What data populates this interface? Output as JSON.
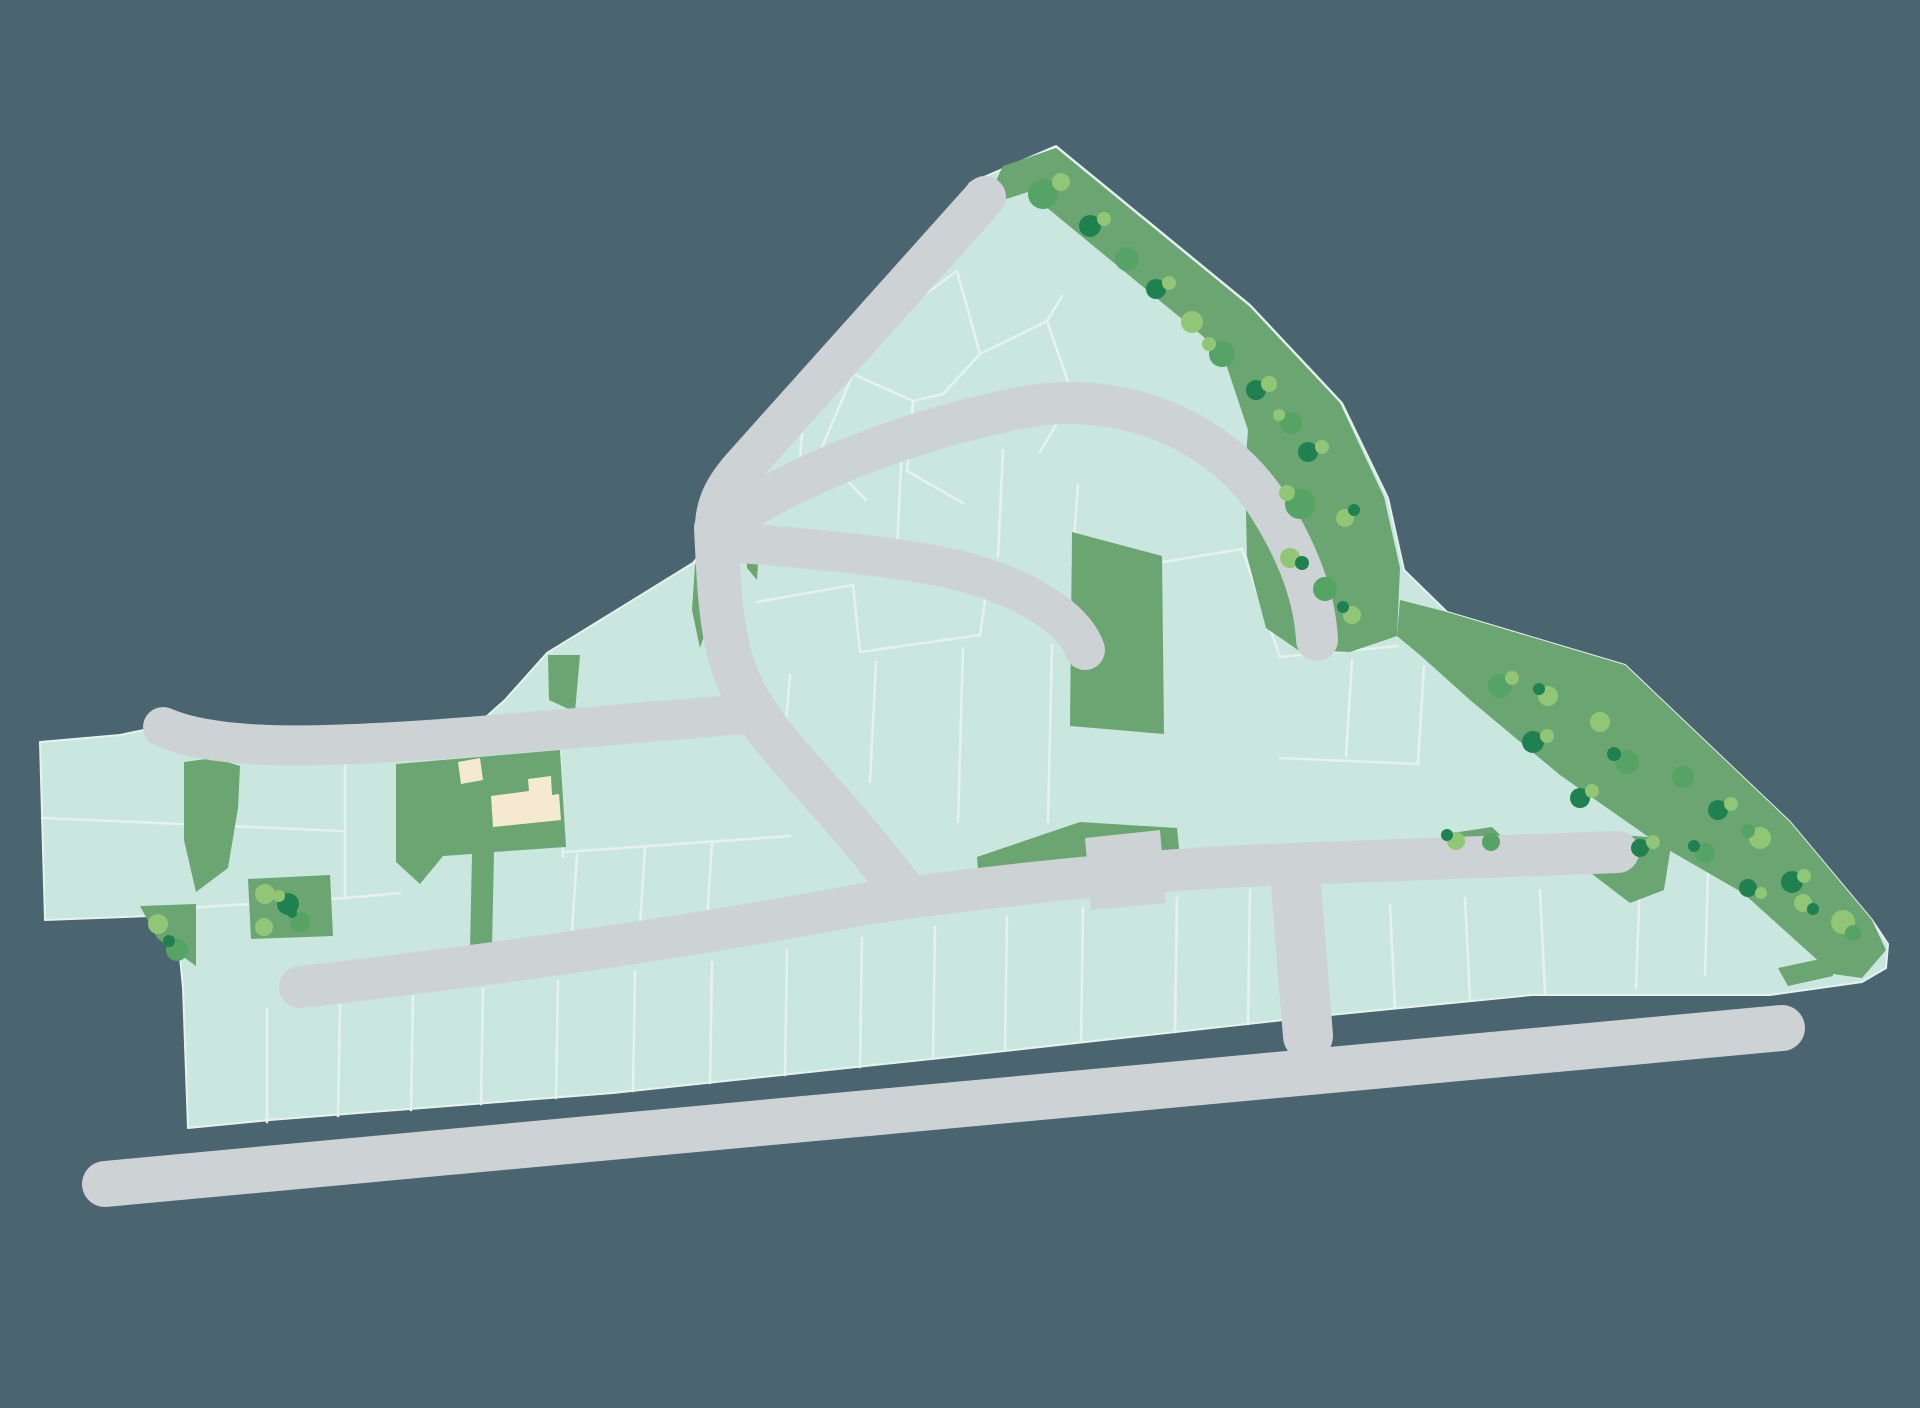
{
  "meta": {
    "title": "Residential development site plan",
    "canvas": {
      "width": 1920,
      "height": 1408
    }
  },
  "palette": {
    "background": "#4b6570",
    "parcel": "#c9e7df",
    "parcel_line": "#e6f2ee",
    "green": "#6ba572",
    "road": "#cdd2d4",
    "building": "#f6e9d2",
    "tree_light": "#90c675",
    "tree_mid": "#55a365",
    "tree_dark": "#1f8050"
  },
  "icons": {
    "tree_glyph": "circle-blob-cluster",
    "road_end_glyph": "rounded-cap",
    "building_glyph": "cream-footprint"
  },
  "site_outline": "970,183 1056,146 1250,305 1342,403 1388,498 1404,570 1447,612 1625,665 1790,822 1872,920 1888,944 1886,968 1862,982 1770,995 1532,995 1320,1016 950,1057 613,1093 270,1120 188,1128 183,988 176,915 45,920 40,742 120,735 163,726 300,747 460,740 505,700 547,653 693,563 712,540 716,528 860,365",
  "green_areas": [
    {
      "name": "northeast-tree-belt",
      "points": "1003,166 1056,148 1250,307 1340,403 1384,497 1400,568 1397,636 1350,652 1298,650 1266,628 1247,556 1245,470 1248,430 1222,352 1028,192 984,206"
    },
    {
      "name": "southeast-tree-belt",
      "points": "1400,600 1447,612 1625,665 1790,822 1872,920 1886,950 1862,978 1833,974 1743,893 1660,845 1560,775 1470,700 1420,655 1397,636"
    },
    {
      "name": "central-green-strip",
      "points": "1072,532 1162,556 1164,734 1070,726"
    },
    {
      "name": "building-parcel-green",
      "points": "396,764 560,750 566,847 494,852 492,948 470,950 472,854 443,856 420,884 396,862"
    },
    {
      "name": "west-green-wedge",
      "points": "184,762 214,758 240,766 238,808 228,868 196,892 184,840"
    },
    {
      "name": "southwest-corner-green",
      "points": "140,906 196,904 196,966 157,938"
    },
    {
      "name": "west-tree-pocket",
      "points": "248,879 330,875 333,936 251,939"
    },
    {
      "name": "roadside-green-mound",
      "points": "1437,857 1452,833 1492,827 1517,851 1517,858"
    },
    {
      "name": "east-road-head-green",
      "points": "1585,832 1672,839 1664,890 1630,903 1592,874"
    },
    {
      "name": "bypass-corner-green",
      "points": "1778,968 1830,957 1833,976 1788,986"
    },
    {
      "name": "driveway-green",
      "points": "977,857 1080,822 1177,828 1180,858 1080,874 979,884"
    },
    {
      "name": "green-sliver-a",
      "points": "548,655 580,655 575,712 549,700"
    },
    {
      "name": "green-sliver-b",
      "points": "695,565 713,545 716,600 700,648 692,610"
    },
    {
      "name": "green-sliver-c",
      "points": "745,538 760,532 757,580 747,568"
    }
  ],
  "roads": [
    {
      "name": "bypass-road",
      "d": "M105,1184 L1782,1028",
      "width": 46
    },
    {
      "name": "lower-spine-road",
      "d": "M300,987 C520,962 700,935 870,903 C1050,878 1180,868 1290,864 L1618,852",
      "width": 42
    },
    {
      "name": "west-access-road",
      "d": "M163,727 C220,752 330,748 480,736 C590,727 680,720 756,713",
      "width": 40
    },
    {
      "name": "central-link-road",
      "d": "M716,528 C720,610 722,652 748,700 C778,752 830,795 905,893",
      "width": 44
    },
    {
      "name": "north-diagonal-road",
      "d": "M985,197 L745,465 C725,487 716,505 716,528",
      "width": 42
    },
    {
      "name": "north-arc-road",
      "d": "M716,528 C790,478 900,432 1020,408 C1120,388 1220,430 1268,505 C1300,555 1315,600 1317,640",
      "width": 42
    },
    {
      "name": "central-spur-road",
      "d": "M740,543 C830,550 910,558 965,572 C1030,590 1075,620 1085,650",
      "width": 40
    },
    {
      "name": "connector-road",
      "d": "M1295,872 L1308,1036",
      "width": 50
    }
  ],
  "driveway": {
    "name": "driveway-pad",
    "points": "1085,838 1160,830 1166,903 1091,910"
  },
  "buildings": [
    {
      "name": "outbuilding",
      "points": "458,762 480,758 483,780 461,784"
    },
    {
      "name": "main-building",
      "points": "491,796 529,791 528,779 551,776 552,795 559,794 561,820 493,827"
    }
  ],
  "plot_lines": [
    [
      42,
      818,
      343,
      831
    ],
    [
      345,
      740,
      345,
      898
    ],
    [
      186,
      908,
      345,
      898
    ],
    [
      345,
      898,
      400,
      893
    ],
    [
      560,
      752,
      563,
      857
    ],
    [
      566,
      852,
      790,
      836
    ],
    [
      577,
      855,
      572,
      930
    ],
    [
      645,
      848,
      640,
      925
    ],
    [
      712,
      842,
      707,
      920
    ],
    [
      803,
      418,
      797,
      502
    ],
    [
      903,
      428,
      897,
      547
    ],
    [
      1003,
      450,
      998,
      557
    ],
    [
      1078,
      485,
      1072,
      565
    ],
    [
      757,
      602,
      853,
      585
    ],
    [
      853,
      585,
      860,
      652
    ],
    [
      860,
      652,
      980,
      635
    ],
    [
      980,
      635,
      988,
      580
    ],
    [
      790,
      675,
      785,
      732
    ],
    [
      876,
      662,
      870,
      782
    ],
    [
      963,
      648,
      958,
      822
    ],
    [
      1052,
      645,
      1048,
      822
    ],
    [
      893,
      318,
      957,
      271
    ],
    [
      957,
      271,
      980,
      354
    ],
    [
      980,
      354,
      943,
      394
    ],
    [
      943,
      394,
      913,
      401
    ],
    [
      893,
      318,
      853,
      374
    ],
    [
      853,
      374,
      913,
      401
    ],
    [
      853,
      374,
      820,
      452
    ],
    [
      913,
      401,
      907,
      471
    ],
    [
      980,
      354,
      1047,
      321
    ],
    [
      1047,
      321,
      1062,
      296
    ],
    [
      1047,
      321,
      1073,
      396
    ],
    [
      1073,
      396,
      1122,
      414
    ],
    [
      907,
      471,
      963,
      503
    ],
    [
      820,
      452,
      866,
      500
    ],
    [
      1073,
      396,
      1040,
      452
    ],
    [
      1163,
      562,
      1242,
      549
    ],
    [
      1242,
      549,
      1280,
      657
    ],
    [
      1280,
      657,
      1398,
      646
    ],
    [
      1352,
      660,
      1346,
      756
    ],
    [
      1424,
      666,
      1418,
      762
    ],
    [
      1280,
      758,
      1418,
      764
    ],
    [
      1390,
      905,
      1395,
      1008
    ],
    [
      1465,
      898,
      1470,
      1000
    ],
    [
      1540,
      890,
      1545,
      993
    ],
    [
      1640,
      879,
      1636,
      988
    ],
    [
      1708,
      872,
      1705,
      975
    ],
    [
      267,
      1009,
      267,
      1122
    ],
    [
      340,
      1002,
      338,
      1116
    ],
    [
      413,
      996,
      411,
      1110
    ],
    [
      483,
      989,
      481,
      1104
    ],
    [
      558,
      981,
      556,
      1098
    ],
    [
      635,
      972,
      633,
      1091
    ],
    [
      712,
      962,
      710,
      1083
    ],
    [
      787,
      950,
      785,
      1075
    ],
    [
      862,
      938,
      860,
      1067
    ],
    [
      935,
      927,
      933,
      1058
    ],
    [
      1007,
      917,
      1005,
      1050
    ],
    [
      1083,
      908,
      1081,
      1042
    ],
    [
      1177,
      898,
      1175,
      1032
    ],
    [
      1250,
      890,
      1248,
      1024
    ]
  ],
  "trees": [
    [
      1043,
      194,
      15,
      "mid"
    ],
    [
      1061,
      182,
      9,
      "light"
    ],
    [
      1090,
      226,
      11,
      "dark"
    ],
    [
      1104,
      219,
      7,
      "light"
    ],
    [
      1127,
      259,
      12,
      "mid"
    ],
    [
      1156,
      289,
      10,
      "dark"
    ],
    [
      1169,
      283,
      7,
      "light"
    ],
    [
      1192,
      322,
      11,
      "light"
    ],
    [
      1222,
      354,
      13,
      "mid"
    ],
    [
      1209,
      344,
      7,
      "light"
    ],
    [
      1256,
      390,
      10,
      "dark"
    ],
    [
      1269,
      384,
      8,
      "light"
    ],
    [
      1291,
      423,
      11,
      "mid"
    ],
    [
      1279,
      415,
      6,
      "light"
    ],
    [
      1308,
      452,
      10,
      "dark"
    ],
    [
      1322,
      447,
      7,
      "light"
    ],
    [
      1300,
      504,
      15,
      "mid"
    ],
    [
      1287,
      493,
      8,
      "light"
    ],
    [
      1345,
      518,
      9,
      "light"
    ],
    [
      1354,
      510,
      6,
      "dark"
    ],
    [
      1290,
      558,
      10,
      "light"
    ],
    [
      1302,
      563,
      7,
      "dark"
    ],
    [
      1325,
      589,
      12,
      "mid"
    ],
    [
      1352,
      615,
      9,
      "light"
    ],
    [
      1343,
      607,
      6,
      "dark"
    ],
    [
      1500,
      686,
      12,
      "mid"
    ],
    [
      1512,
      678,
      7,
      "light"
    ],
    [
      1548,
      696,
      10,
      "light"
    ],
    [
      1539,
      689,
      6,
      "dark"
    ],
    [
      1533,
      742,
      11,
      "dark"
    ],
    [
      1547,
      736,
      7,
      "light"
    ],
    [
      1600,
      722,
      10,
      "light"
    ],
    [
      1627,
      762,
      12,
      "mid"
    ],
    [
      1614,
      754,
      7,
      "dark"
    ],
    [
      1580,
      798,
      10,
      "dark"
    ],
    [
      1592,
      791,
      7,
      "light"
    ],
    [
      1683,
      777,
      11,
      "mid"
    ],
    [
      1718,
      810,
      10,
      "dark"
    ],
    [
      1731,
      804,
      7,
      "light"
    ],
    [
      1705,
      853,
      10,
      "mid"
    ],
    [
      1694,
      846,
      6,
      "dark"
    ],
    [
      1760,
      838,
      11,
      "light"
    ],
    [
      1748,
      831,
      7,
      "mid"
    ],
    [
      1792,
      882,
      11,
      "dark"
    ],
    [
      1804,
      876,
      7,
      "light"
    ],
    [
      1748,
      888,
      9,
      "dark"
    ],
    [
      1761,
      893,
      6,
      "light"
    ],
    [
      1803,
      903,
      9,
      "light"
    ],
    [
      1813,
      909,
      6,
      "dark"
    ],
    [
      1843,
      922,
      12,
      "light"
    ],
    [
      1853,
      933,
      8,
      "mid"
    ],
    [
      1640,
      848,
      9,
      "dark"
    ],
    [
      1653,
      842,
      7,
      "light"
    ],
    [
      1456,
      841,
      9,
      "light"
    ],
    [
      1447,
      835,
      6,
      "dark"
    ],
    [
      1491,
      842,
      9,
      "mid"
    ],
    [
      158,
      924,
      10,
      "light"
    ],
    [
      177,
      950,
      11,
      "mid"
    ],
    [
      169,
      941,
      6,
      "dark"
    ],
    [
      265,
      894,
      10,
      "light"
    ],
    [
      288,
      904,
      11,
      "dark"
    ],
    [
      279,
      896,
      6,
      "light"
    ],
    [
      264,
      927,
      9,
      "light"
    ],
    [
      300,
      922,
      10,
      "mid"
    ],
    [
      292,
      913,
      5,
      "dark"
    ]
  ]
}
